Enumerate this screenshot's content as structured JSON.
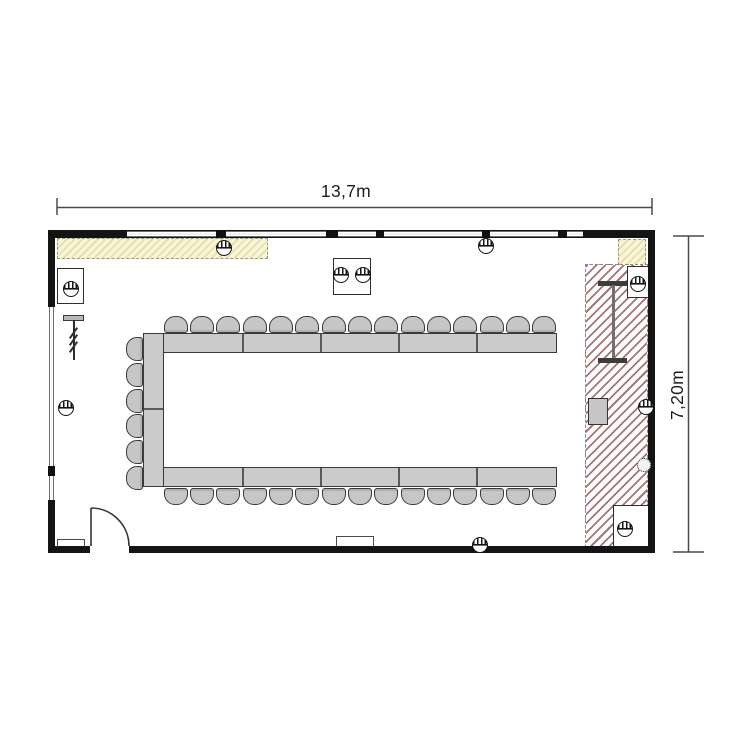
{
  "plan": {
    "type": "floor-plan",
    "dimension_labels": {
      "width": "13,7m",
      "height": "7,20m"
    },
    "colors": {
      "wall": "#141414",
      "furniture_fill": "#cbcbcb",
      "hatch_red_line": "#965c5c",
      "hatch_yellow_bg": "#f8f4da",
      "dimension_line": "#4a4a4a"
    },
    "furniture": {
      "u_table": {
        "segments_top": 5,
        "segments_bottom": 5,
        "segments_left": 2,
        "seats_top": 15,
        "seats_bottom": 15,
        "seats_left": 6,
        "total_seats": 36
      },
      "side_tables": [
        {
          "name": "table-top-left",
          "seats": 1
        },
        {
          "name": "table-top-center",
          "seats": 2
        },
        {
          "name": "table-top-right",
          "seats": 1
        },
        {
          "name": "table-bottom-right",
          "seats": 1
        }
      ],
      "fixtures": [
        "coat-rack",
        "projection-screen",
        "lectern",
        "radiator-left",
        "radiator-center",
        "entrance-door"
      ]
    },
    "icons": {
      "round_chairs": [
        "chair-top-left-table",
        "chair-top-center-table-1",
        "chair-top-center-table-2",
        "chair-top-right-table",
        "chair-bottom-right-table"
      ],
      "wall_fixtures": [
        "wall-lamp-top-left",
        "wall-lamp-top-right",
        "wall-lamp-left",
        "wall-lamp-bottom",
        "wall-lamp-right"
      ],
      "other": [
        "socket-cluster-icon"
      ]
    }
  }
}
